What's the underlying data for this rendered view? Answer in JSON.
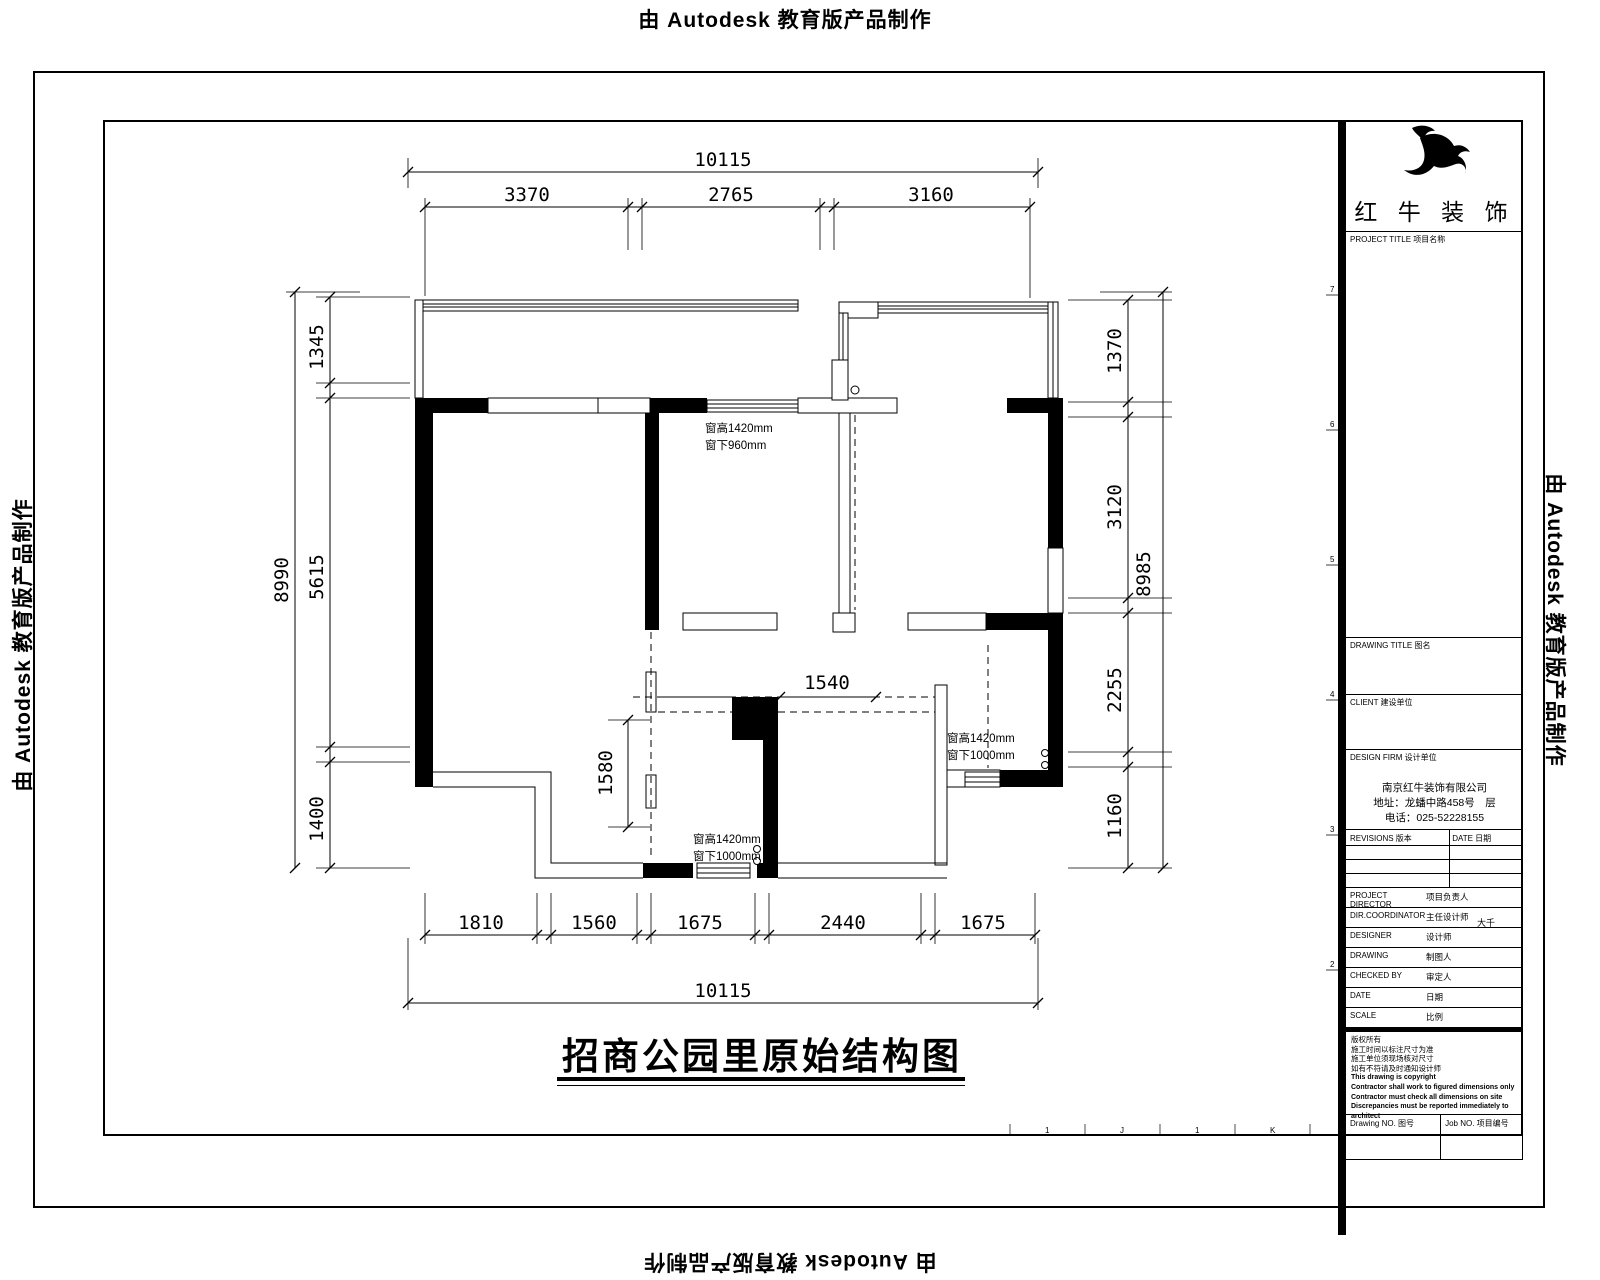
{
  "watermark": {
    "text": "由 Autodesk 教育版产品制作"
  },
  "drawing": {
    "title": "招商公园里原始结构图",
    "dims": {
      "top_overall": "10115",
      "top_segments": [
        "3370",
        "2765",
        "3160"
      ],
      "bottom_segments": [
        "1810",
        "1560",
        "1675",
        "2440",
        "1675"
      ],
      "bottom_overall": "10115",
      "left_overall": "8990",
      "left_segments": [
        "1345",
        "5615",
        "1400"
      ],
      "right_overall": "8985",
      "right_segments": [
        "1370",
        "3120",
        "2255",
        "1160"
      ],
      "interior_width": "1540",
      "interior_height": "1580"
    },
    "windows": {
      "top": {
        "line1": "窗高1420mm",
        "line2": "窗下960mm"
      },
      "right": {
        "line1": "窗高1420mm",
        "line2": "窗下1000mm"
      },
      "bottom": {
        "line1": "窗高1420mm",
        "line2": "窗下1000mm"
      }
    },
    "zone_marks": {
      "left": [
        "7",
        "6",
        "5",
        "4",
        "3",
        "2"
      ],
      "bottom": [
        "1",
        "J",
        "1",
        "K"
      ]
    }
  },
  "title_block": {
    "brand": "红 牛 装 饰",
    "project_title_label": "PROJECT TITLE 项目名称",
    "drawing_title_label": "DRAWING TITLE 图名",
    "client_label": "CLIENT 建设单位",
    "design_firm_label": "DESIGN FIRM 设计单位",
    "company": {
      "name": "南京红牛装饰有限公司",
      "address": "地址：龙蟠中路458号　层",
      "phone": "电话：025-52228155"
    },
    "revisions_label": "REVISIONS 版本",
    "revision_date_label": "DATE 日期",
    "rows": [
      {
        "en": "PROJECT DIRECTOR",
        "cn": "项目负责人",
        "value": ""
      },
      {
        "en": "DIR.COORDINATOR",
        "cn": "主任设计师",
        "value": "大千"
      },
      {
        "en": "DESIGNER",
        "cn": "设计师",
        "value": ""
      },
      {
        "en": "DRAWING",
        "cn": "制图人",
        "value": ""
      },
      {
        "en": "CHECKED BY",
        "cn": "审定人",
        "value": ""
      },
      {
        "en": "DATE",
        "cn": "日期",
        "value": ""
      },
      {
        "en": "SCALE",
        "cn": "比例",
        "value": ""
      }
    ],
    "copyright": [
      "版权所有",
      "施工时间以标注尺寸为准",
      "施工单位须现场核对尺寸",
      "如有不符请及时通知设计师",
      "This drawing is copyright",
      "Contractor shall work to figured dimensions only",
      "Contractor must check all dimensions on site",
      "Discrepancies must be reported immediately to architect"
    ],
    "drawing_no_label": "Drawing NO. 图号",
    "job_no_label": "Job NO. 项目编号"
  }
}
